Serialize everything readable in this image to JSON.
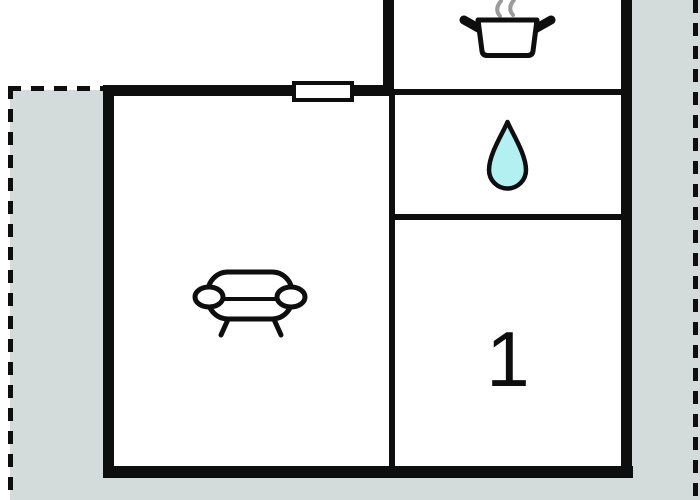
{
  "floorplan": {
    "rooms": {
      "bedroom_label": "1",
      "kitchen_icon": "cooking-pot-icon",
      "bathroom_icon": "water-drop-icon",
      "living_room_icon": "sofa-icon"
    },
    "colors": {
      "wall": "#0e0e0e",
      "terrace": "#d4dbdb",
      "drop_fill": "#b2f0f2",
      "steam": "#9b9b9b",
      "background": "#ffffff"
    }
  }
}
